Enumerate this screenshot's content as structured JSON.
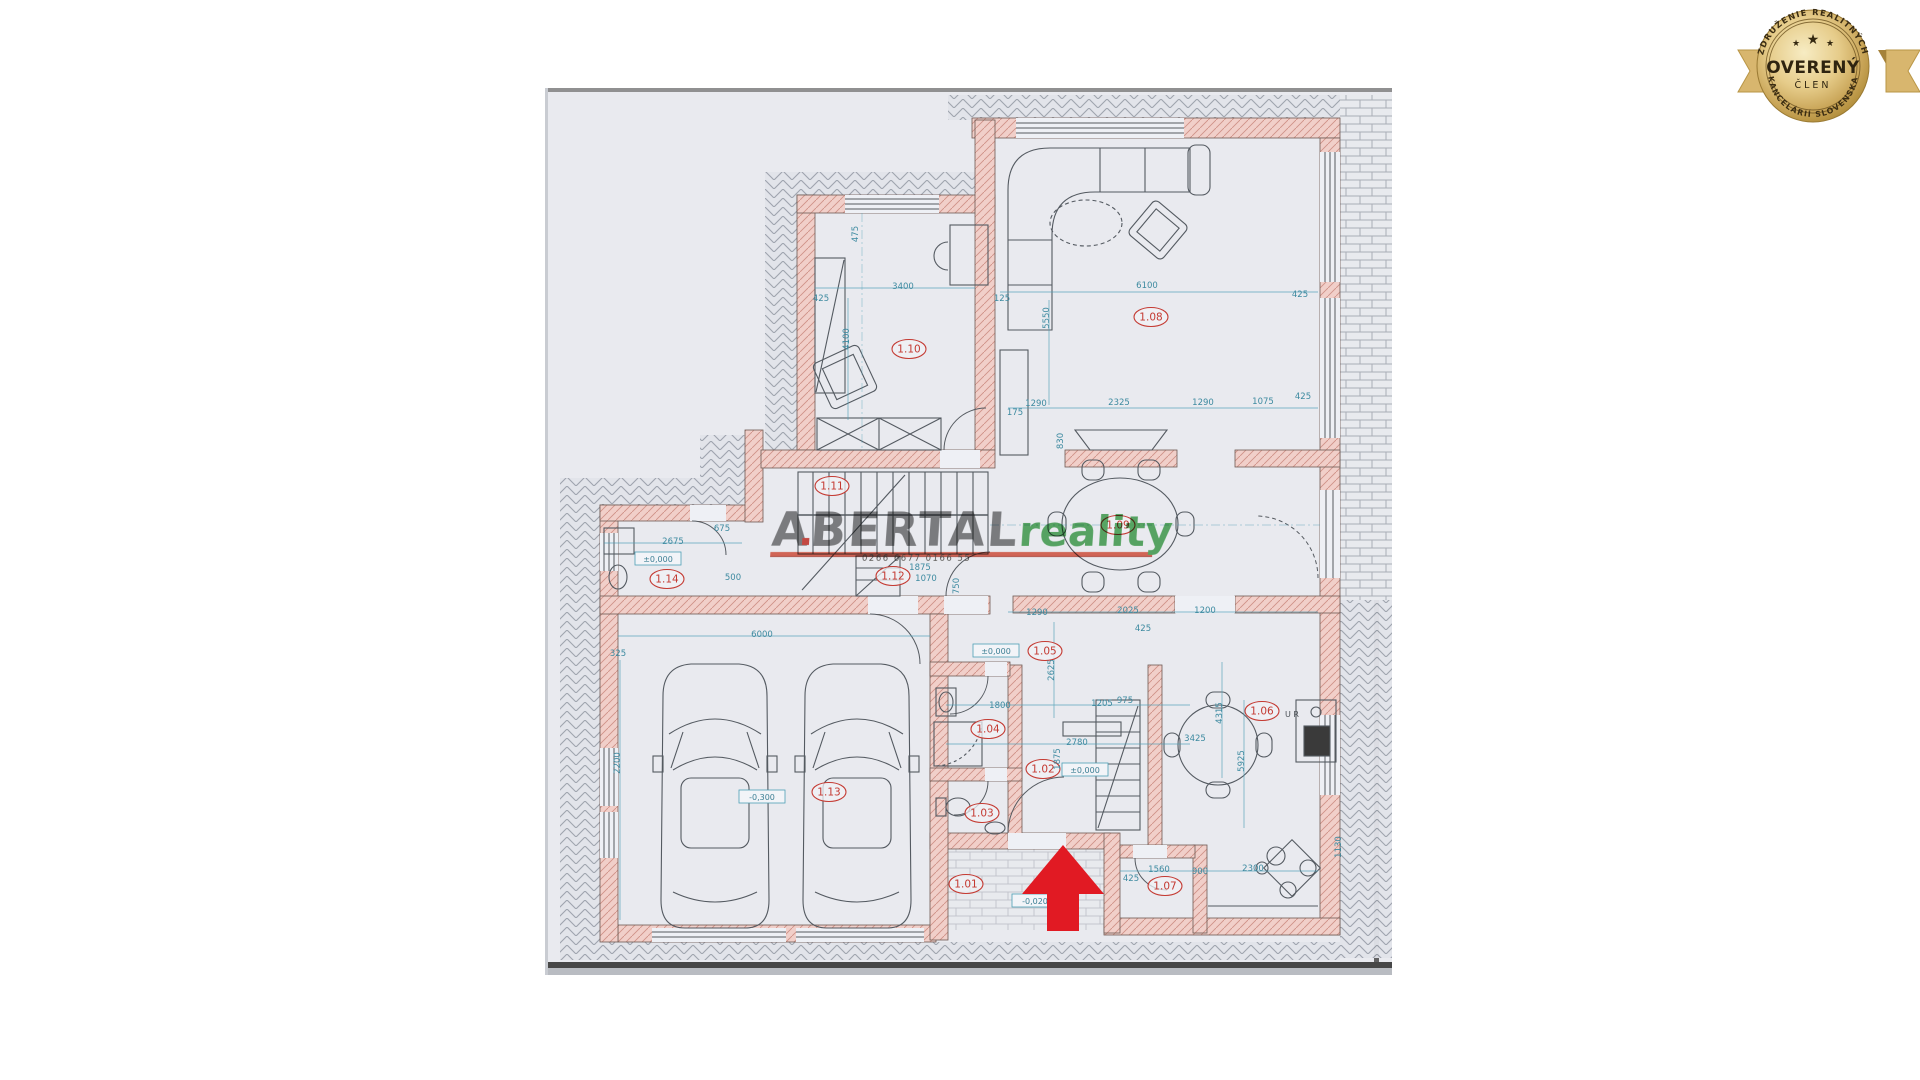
{
  "colors": {
    "sheet": "#e9eaef",
    "wall_fill": "#f1cfc9",
    "wall_hatch": "#cf9288",
    "dimension": "#3d8aa0",
    "room_label": "#c43a32",
    "watermark_gray": "#6f6f6f",
    "watermark_green": "#3fa24b",
    "watermark_underline": "#e0523c",
    "arrow_red": "#e11a23",
    "badge_gold": "#c9a74f",
    "badge_text": "#342810"
  },
  "badge": {
    "top_text": "ZDRUŽENIE REALITNÝCH",
    "bottom_text": "KANCELÁRIÍ SLOVENSKA",
    "word_main": "OVERENÝ",
    "word_sub": "ČLEN",
    "star": "★"
  },
  "watermark": {
    "brand_bold": "ABERTAL",
    "brand_light": "reality",
    "small_text": "0266 6677 0166 55"
  },
  "plan": {
    "room_labels": [
      {
        "t": "1.01",
        "x": 966,
        "y": 884
      },
      {
        "t": "1.02",
        "x": 1043,
        "y": 769
      },
      {
        "t": "1.03",
        "x": 982,
        "y": 813
      },
      {
        "t": "1.04",
        "x": 988,
        "y": 729
      },
      {
        "t": "1.05",
        "x": 1045,
        "y": 651
      },
      {
        "t": "1.06",
        "x": 1262,
        "y": 711
      },
      {
        "t": "1.07",
        "x": 1165,
        "y": 886
      },
      {
        "t": "1.08",
        "x": 1151,
        "y": 317
      },
      {
        "t": "1.09",
        "x": 1118,
        "y": 525
      },
      {
        "t": "1.10",
        "x": 909,
        "y": 349
      },
      {
        "t": "1.11",
        "x": 832,
        "y": 486
      },
      {
        "t": "1.12",
        "x": 893,
        "y": 576
      },
      {
        "t": "1.13",
        "x": 829,
        "y": 792
      },
      {
        "t": "1.14",
        "x": 667,
        "y": 579
      }
    ],
    "elevations": [
      {
        "t": "±0,000",
        "x": 658,
        "y": 559
      },
      {
        "t": "±0,000",
        "x": 996,
        "y": 651
      },
      {
        "t": "±0,000",
        "x": 1085,
        "y": 770
      },
      {
        "t": "-0,300",
        "x": 762,
        "y": 797
      },
      {
        "t": "-0,020",
        "x": 1035,
        "y": 901
      }
    ],
    "dimensions": [
      {
        "t": "6100",
        "x": 1147,
        "y": 288
      },
      {
        "t": "125",
        "x": 1002,
        "y": 301
      },
      {
        "t": "425",
        "x": 1300,
        "y": 297
      },
      {
        "t": "1290",
        "x": 1036,
        "y": 406
      },
      {
        "t": "2325",
        "x": 1119,
        "y": 405
      },
      {
        "t": "1290",
        "x": 1203,
        "y": 405
      },
      {
        "t": "1075",
        "x": 1263,
        "y": 404
      },
      {
        "t": "425",
        "x": 1303,
        "y": 399
      },
      {
        "t": "175",
        "x": 1015,
        "y": 415
      },
      {
        "t": "3400",
        "x": 903,
        "y": 289
      },
      {
        "t": "425",
        "x": 821,
        "y": 301
      },
      {
        "t": "475",
        "x": 858,
        "y": 234,
        "r": -90
      },
      {
        "t": "4100",
        "x": 849,
        "y": 339,
        "r": -90
      },
      {
        "t": "5550",
        "x": 1049,
        "y": 318,
        "r": -90
      },
      {
        "t": "2675",
        "x": 673,
        "y": 544
      },
      {
        "t": "675",
        "x": 722,
        "y": 531
      },
      {
        "t": "500",
        "x": 733,
        "y": 580
      },
      {
        "t": "6000",
        "x": 762,
        "y": 637
      },
      {
        "t": "325",
        "x": 618,
        "y": 656
      },
      {
        "t": "2200",
        "x": 620,
        "y": 763,
        "r": -90
      },
      {
        "t": "1290",
        "x": 1037,
        "y": 615
      },
      {
        "t": "2025",
        "x": 1128,
        "y": 613
      },
      {
        "t": "1200",
        "x": 1205,
        "y": 613
      },
      {
        "t": "425",
        "x": 1143,
        "y": 631
      },
      {
        "t": "1800",
        "x": 1000,
        "y": 708
      },
      {
        "t": "1205",
        "x": 1102,
        "y": 706
      },
      {
        "t": "975",
        "x": 1125,
        "y": 703
      },
      {
        "t": "2780",
        "x": 1077,
        "y": 745
      },
      {
        "t": "2625",
        "x": 1054,
        "y": 670,
        "r": -90
      },
      {
        "t": "1875",
        "x": 1060,
        "y": 759,
        "r": -90
      },
      {
        "t": "4315",
        "x": 1222,
        "y": 713,
        "r": -90
      },
      {
        "t": "5925",
        "x": 1244,
        "y": 761,
        "r": -90
      },
      {
        "t": "3425",
        "x": 1195,
        "y": 741
      },
      {
        "t": "1560",
        "x": 1159,
        "y": 872
      },
      {
        "t": "900",
        "x": 1200,
        "y": 874
      },
      {
        "t": "2300",
        "x": 1253,
        "y": 871
      },
      {
        "t": "425",
        "x": 1131,
        "y": 881
      },
      {
        "t": "1130",
        "x": 1341,
        "y": 847,
        "r": -90
      },
      {
        "t": "1875",
        "x": 920,
        "y": 570
      },
      {
        "t": "1070",
        "x": 926,
        "y": 581
      },
      {
        "t": "750",
        "x": 959,
        "y": 586,
        "r": -90
      },
      {
        "t": "830",
        "x": 1063,
        "y": 441,
        "r": -90
      }
    ],
    "notes": [
      {
        "t": "U R",
        "x": 1292,
        "y": 717
      }
    ]
  }
}
